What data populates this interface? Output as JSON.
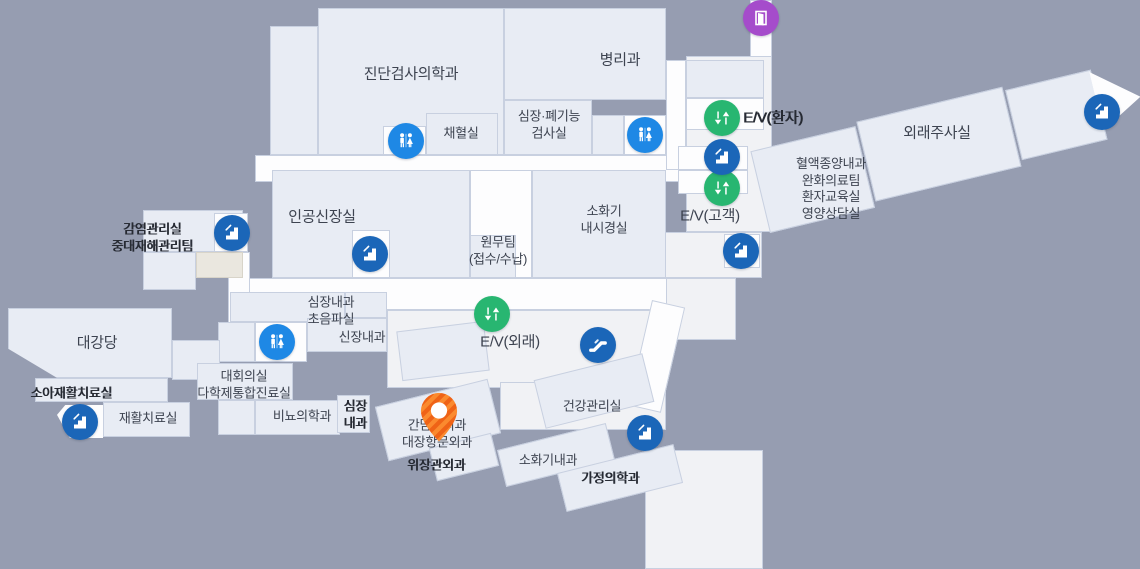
{
  "map": {
    "type": "hospital-floor-map",
    "colors": {
      "bg": "#969db1",
      "room": "#e8ecf4",
      "room-border": "#c8d0e0",
      "corridor": "#fdfdfe",
      "floor": "#f1f2f5",
      "beige": "#eae7df",
      "restroom-blue": "#1e88e5",
      "stairs-blue": "#1b66b8",
      "elevator-green": "#28b671",
      "door-purple": "#a54ccb",
      "pin-orange": "#fb8a2e",
      "pin-stripe": "#ef6316",
      "text": "#3d4350"
    },
    "icons": {
      "restroom": "restroom-icon (man+woman figures, blue circle)",
      "stairs": "stairs-icon (steps, dark blue circle)",
      "elevator": "elevator-icon (down+up arrows, green circle)",
      "escalator": "escalator-icon (diagonal ramp, blue circle)",
      "door": "door-icon (exit door, purple circle)",
      "pin": "location-pin (striped orange map marker)"
    }
  },
  "labels": {
    "diagnostic_lab": "진단검사의학과",
    "pathology": "병리과",
    "blood_collection": "채혈실",
    "cardiopulmonary": "심장·폐기능\n검사실",
    "ev_patient": "E/V(환자)",
    "hemato_oncology": "혈액종양내과\n완화의료팀\n환자교육실\n영양상담실",
    "outpatient_injection": "외래주사실",
    "ev_customer": "E/V(고객)",
    "artificial_kidney": "인공신장실",
    "infection_control": "감염관리실\n중대재해관리팀",
    "admin_team": "원무팀\n(접수/수납)",
    "gi_endoscopy": "소화기\n내시경실",
    "ev_outpatient": "E/V(외래)",
    "cardio_ultrasound": "심장내과\n초음파실",
    "nephrology": "신장내과",
    "grand_hall": "대강당",
    "conference": "대회의실\n다학제통합진료실",
    "pediatric_rehab": "소아재활치료실",
    "rehab": "재활치료실",
    "urology": "비뇨의학과",
    "cardiology_small": "심장\n내과",
    "surgery_group": "간담췌외과\n대장항문외과",
    "gastro_surgery": "위장관외과",
    "health_mgmt": "건강관리실",
    "gastroenterology": "소화기내과",
    "family_medicine": "가정의학과"
  }
}
